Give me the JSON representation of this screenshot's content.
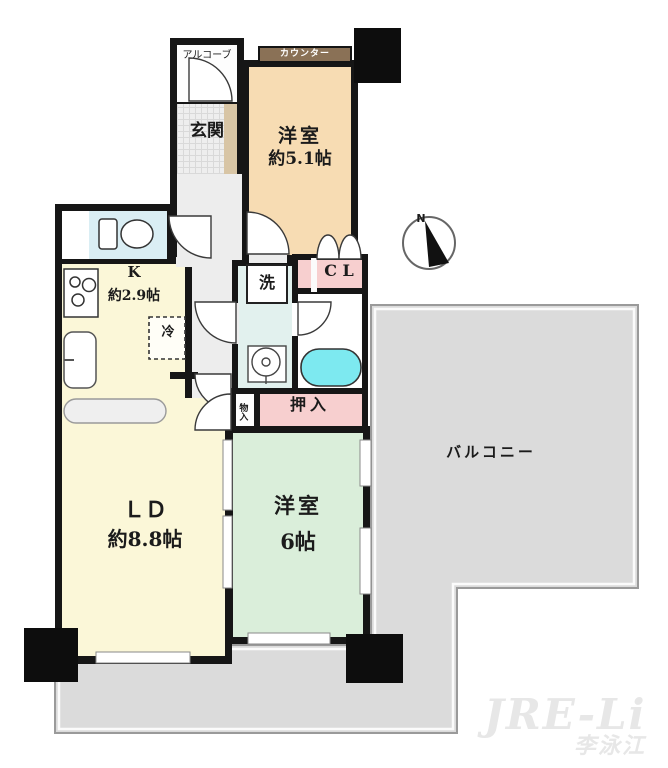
{
  "rooms": {
    "bedroom1": {
      "name": "洋室",
      "size": "約5.1帖"
    },
    "kitchen": {
      "name": "K",
      "size": "約2.9帖"
    },
    "living": {
      "name": "ＬＤ",
      "size": "約8.8帖"
    },
    "bedroom2": {
      "name": "洋室",
      "size": "6帖"
    },
    "balcony": {
      "name": "バルコニー"
    },
    "entrance": {
      "name": "玄関"
    },
    "alcove": {
      "name": "アルコーブ"
    },
    "counter": {
      "name": "カウンター"
    },
    "closet": {
      "name": "C L"
    },
    "oshiire": {
      "name": "押入"
    },
    "monoire": {
      "name": "物入"
    },
    "laundry": {
      "name": "洗"
    },
    "fridge": {
      "name": "冷"
    }
  },
  "compass": {
    "label": "N"
  },
  "watermark": {
    "line1": "JRE-Li",
    "line2": "李泳江"
  },
  "colors": {
    "wall": "#161616",
    "bedroom1": "#f7dcb3",
    "yellow_rooms": "#fbf7d8",
    "bedroom2": "#daeeda",
    "pink": "#f7cfcf",
    "washroom": "#e2f1ee",
    "toilet": "#daeef4",
    "bathtub": "#7de9f0",
    "balcony": "#dbdbdb",
    "counter_strip": "#8a7156"
  }
}
